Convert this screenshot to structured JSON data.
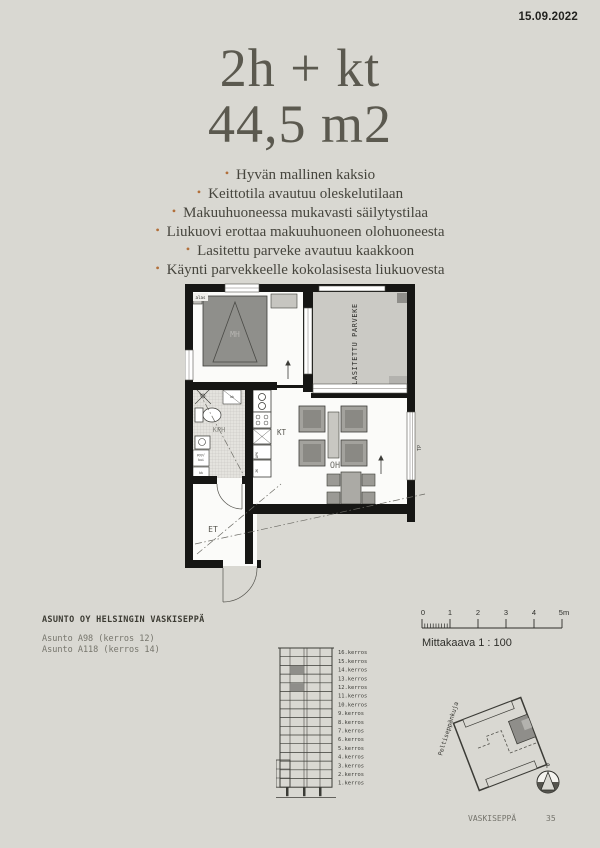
{
  "page": {
    "date": "15.09.2022"
  },
  "header": {
    "title": "2h + kt",
    "subtitle": "44,5 m2"
  },
  "bullets": {
    "char": "•"
  },
  "features": [
    "Hyvän mallinen kaksio",
    "Keittotila avautuu oleskelutilaan",
    "Makuuhuoneessa mukavasti säilytystilaa",
    "Liukuovi erottaa makuuhuoneen olohuoneesta",
    "Lasitettu parveke avautuu kaakkoon",
    "Käynti parvekkeelle kokolasisesta liukuovesta"
  ],
  "floorplan": {
    "rooms": {
      "bedroom": "MH",
      "bathroom": "KPH",
      "kitchenette": "KT",
      "living_room": "OH",
      "hallway": "ET",
      "balcony": "LASITETTU PARVEKE"
    },
    "annotations": {
      "stairs": "alas",
      "balcony_abbr": "TP",
      "dishwasher": "APK",
      "fridge": "JK",
      "laundry_line1": "pyy/",
      "laundry_line2": "kui",
      "closet": "kk"
    }
  },
  "project": {
    "company": "ASUNTO OY HELSINGIN VASKISEPPÄ",
    "apartments": [
      "Asunto A98 (kerros 12)",
      "Asunto A118 (kerros 14)"
    ]
  },
  "scale": {
    "ticks": [
      "0",
      "1",
      "2",
      "3",
      "4",
      "5m"
    ],
    "caption": "Mittakaava 1 : 100"
  },
  "elevation": {
    "floors": [
      "16.kerros",
      "15.kerros",
      "14.kerros",
      "13.kerros",
      "12.kerros",
      "11.kerros",
      "10.kerros",
      "9.kerros",
      "8.kerros",
      "7.kerros",
      "6.kerros",
      "5.kerros",
      "4.kerros",
      "3.kerros",
      "2.kerros",
      "1.kerros"
    ],
    "highlighted_floors": [
      "14.kerros",
      "12.kerros"
    ]
  },
  "siteplan": {
    "street": "Peltiseppänkuja",
    "north_label": "P"
  },
  "footer": {
    "project_name": "VASKISEPPÄ",
    "page_number": "35"
  },
  "colors": {
    "page_bg": "#d9d8d2",
    "accent_bullet": "#b26f3a",
    "wall": "#161614",
    "highlight_gray": "#8f8e8a",
    "ink": "#45443c"
  }
}
